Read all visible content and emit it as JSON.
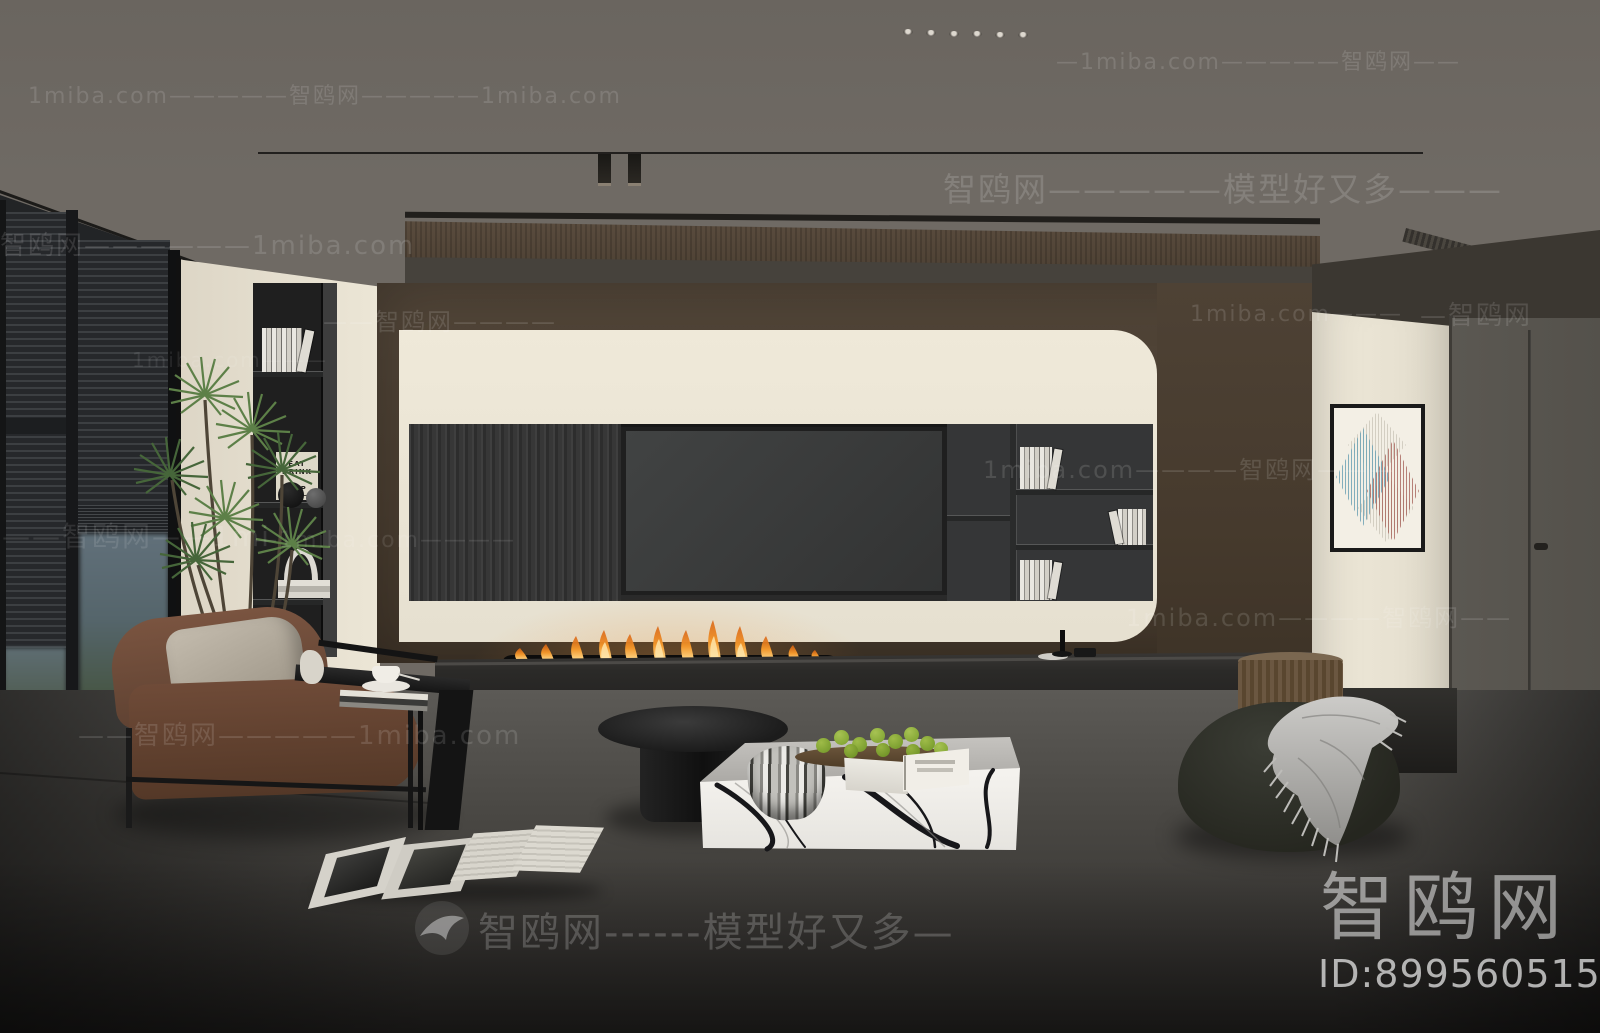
{
  "watermarks": {
    "domain": "1miba.com",
    "site": "智鸥网",
    "slogan": "模型好又多",
    "rows": [
      {
        "text": "—1miba.com—————智鸥网——"
      },
      {
        "text": "1miba.com—————智鸥网—————1miba.com"
      },
      {
        "text": "智鸥网—————模型好又多———"
      },
      {
        "text": "智鸥网——————1miba.com"
      },
      {
        "text": "——智鸥网————"
      },
      {
        "text": "1miba.com———"
      },
      {
        "text": "—智鸥网"
      },
      {
        "text": "1miba.com———"
      },
      {
        "text": "1miba.com————智鸥网———"
      },
      {
        "text": "——智鸥网——1mi"
      },
      {
        "text": "—1miba.com————"
      },
      {
        "text": "1miba.com————智鸥网——"
      },
      {
        "text": "——智鸥网—————1miba.com"
      },
      {
        "text": "智鸥网------模型好又多—"
      }
    ],
    "logo_text": "智鸥网",
    "logo_id": "ID:899560515"
  },
  "poster": {
    "lines": [
      "EAT",
      "DRINK",
      "NAP"
    ]
  },
  "palette": {
    "ceiling": "#6f6a64",
    "cream_wall": "#eae4d4",
    "walnut_wood": "#4a3e31",
    "hearth_black": "#2b2a28",
    "leather_brown": "#6f4b38",
    "fire_orange": "#e8882f",
    "floor_gray": "#474543",
    "art_blue": "#6fa3b5",
    "art_red": "#a8655c"
  }
}
